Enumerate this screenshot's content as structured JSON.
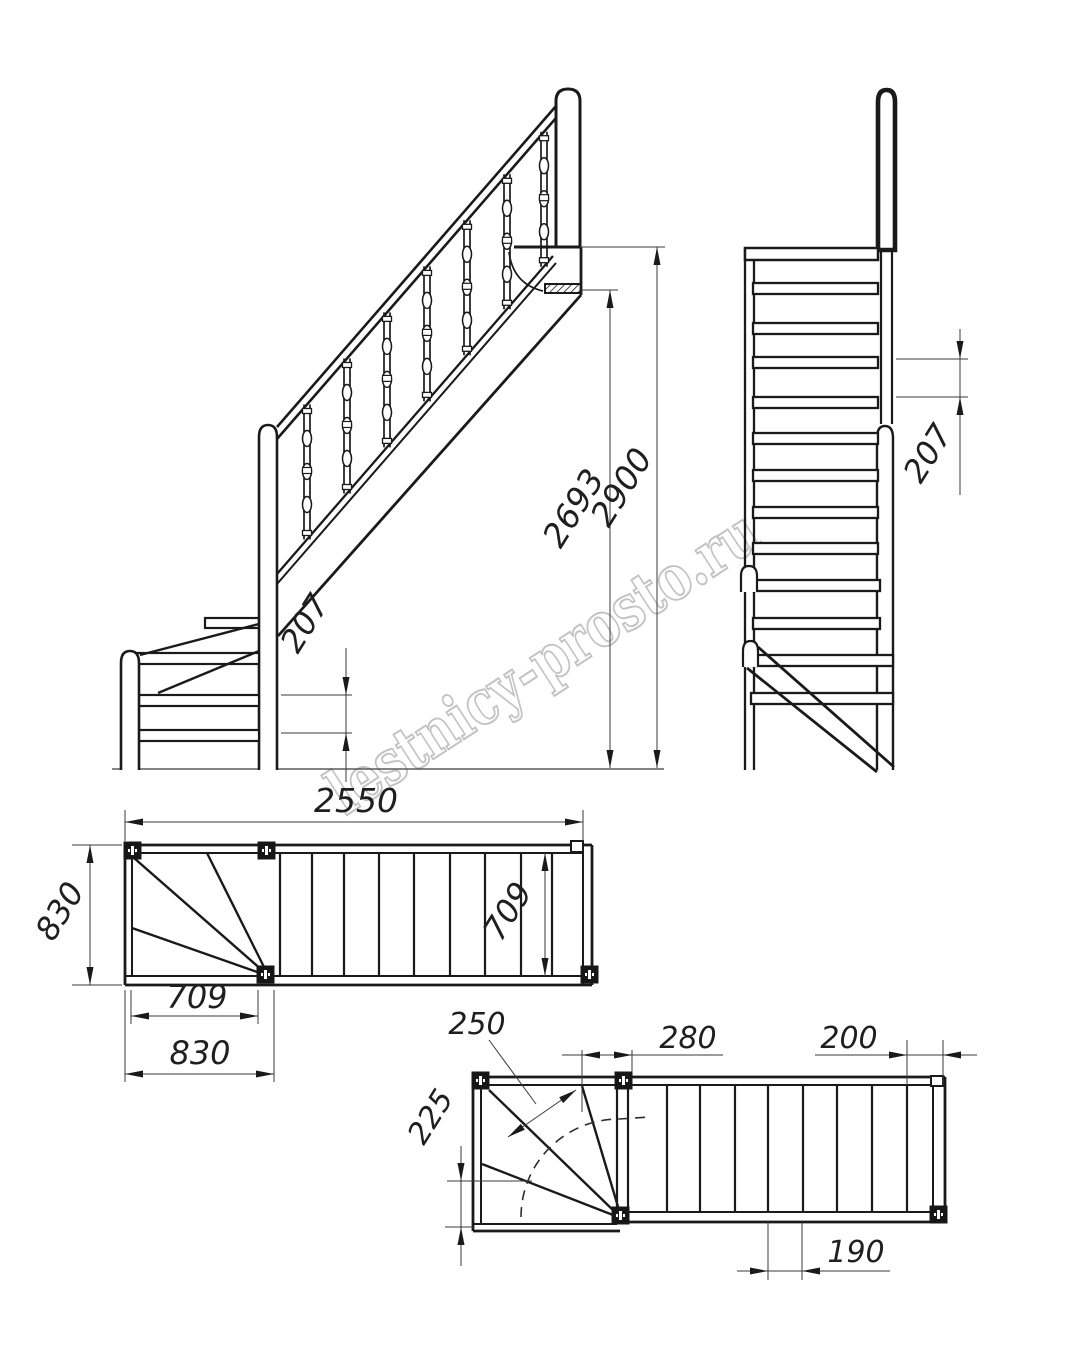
{
  "watermark": "lestnicy-prosto.ru",
  "views": {
    "front": {
      "riser": "207",
      "height_to_top_tread": "2693",
      "total_height": "2900"
    },
    "side": {
      "riser": "207"
    },
    "plan_main": {
      "total_run": "2550",
      "winder_width_left": "830",
      "flight_inner_width": "709",
      "winder_going": "709",
      "winder_width_bottom": "830"
    },
    "plan_detail": {
      "walkline_going": "250",
      "post_offset": "280",
      "last_going": "200",
      "narrow_end": "225",
      "going": "190"
    }
  },
  "colors": {
    "line": "#1b1b1b",
    "dim": "#3a3a3a",
    "watermark": "#9c9c9c",
    "bg": "#ffffff"
  }
}
